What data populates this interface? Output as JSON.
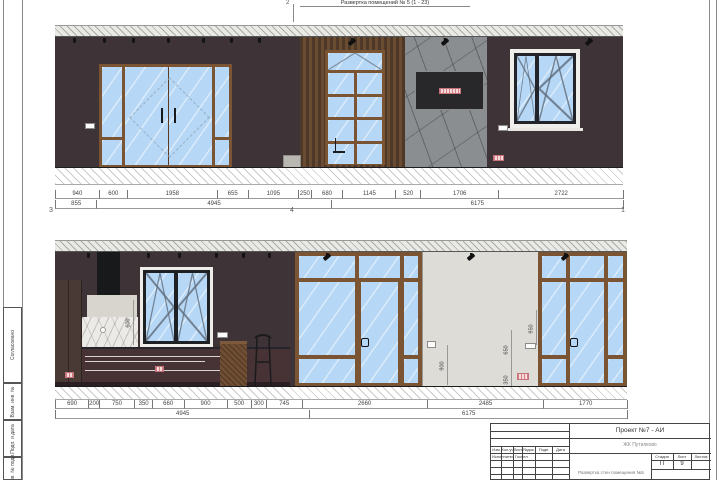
{
  "sheet": {
    "marker2": "2",
    "title": "Развертка помещений № 5 (1 - 23)",
    "stamp_agree": "Согласовано",
    "stamp_vzam": "Взам. инв. №",
    "stamp_podp": "Подп. и дата",
    "stamp_inv": "Инв. № подл."
  },
  "top_elevation": {
    "marker3": "3",
    "marker4": "4",
    "marker1": "1",
    "dims_row1": [
      940,
      600,
      1958,
      655,
      1095,
      250,
      680,
      1145,
      520,
      1706,
      2722
    ],
    "dims_row2": [
      855,
      4945,
      6175
    ]
  },
  "bottom_elevation": {
    "dims_row1": [
      690,
      200,
      750,
      350,
      660,
      900,
      500,
      300,
      745,
      2660,
      2485,
      1770
    ],
    "dims_row2": [
      4945,
      6175
    ],
    "vdims": {
      "kitchen": "600",
      "wall": "900",
      "d650": "650",
      "d350": "350",
      "d950": "950"
    }
  },
  "titleblock": {
    "project": "Проект №7 - АИ",
    "object": "ЖК Путилково",
    "doc_title": "Развертка стен помещения №5",
    "col_izm": "Изм.",
    "col_kol": "Кол.уч",
    "col_list": "Лист",
    "col_ndok": "№док.",
    "col_podp": "Подп.",
    "col_data": "Дата",
    "executor_label": "Исполнитель",
    "executor_name": "Госпел",
    "stage_label": "Стадия",
    "list_label": "Лист",
    "listov_label": "Листов",
    "stage_value": "П",
    "list_value": "9"
  }
}
